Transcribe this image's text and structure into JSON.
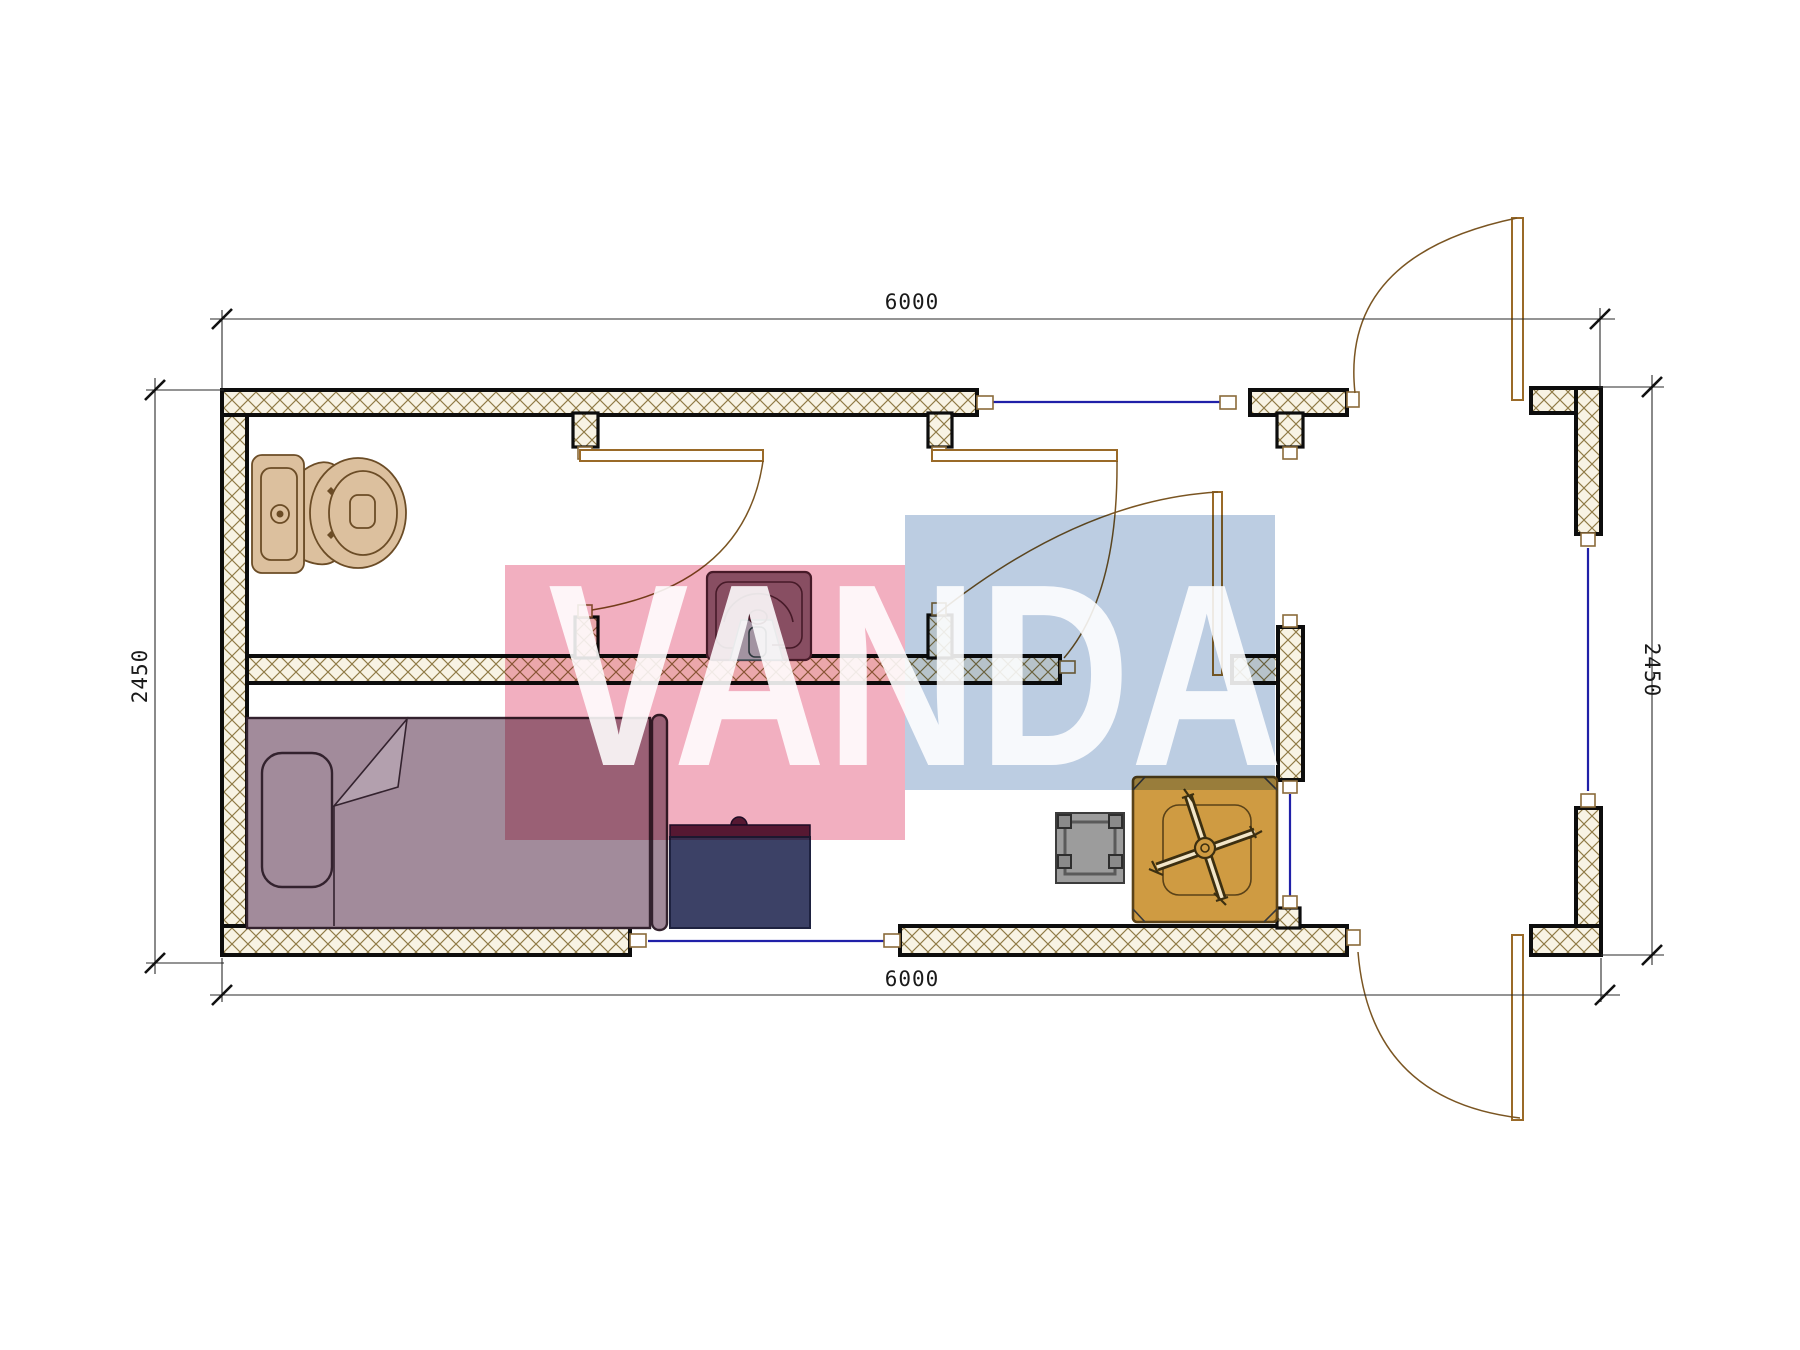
{
  "drawing": {
    "title_note": "floor plan",
    "dimensions": {
      "top": "6000",
      "bottom": "6000",
      "left": "2450",
      "right": "2450"
    },
    "watermark": {
      "text": "VANDA",
      "pink_color": "#f2afc0",
      "blue_color": "#bccde2",
      "text_color": "#ffffff"
    },
    "palette": {
      "wall_outline": "#0d0d0d",
      "wall_hatch": "#8f7a45",
      "wall_fill": "#f8f3e4",
      "window_line": "#2020a8",
      "door_swing": "#7a5522",
      "toilet": "#dcc09e",
      "sink_body": "#8f7182",
      "sink_pedestal": "#abd6d6",
      "bed": "#a28b9b",
      "desk_body": "#3c4166",
      "desk_top": "#5a2242",
      "stool": "#9c9c9c",
      "table": "#cf9b42"
    },
    "furniture": [
      {
        "name": "toilet"
      },
      {
        "name": "washbasin"
      },
      {
        "name": "bed"
      },
      {
        "name": "desk"
      },
      {
        "name": "stool"
      },
      {
        "name": "square-table"
      }
    ]
  }
}
